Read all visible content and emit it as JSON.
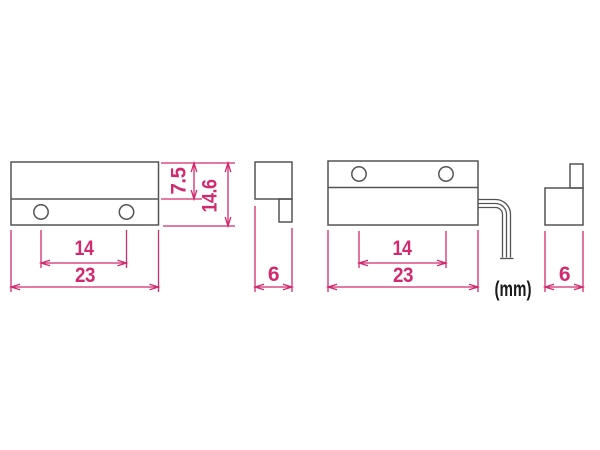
{
  "diagram": {
    "name": "magnetic-contact-switch-dimension-drawing",
    "units_label": "(mm)",
    "colors": {
      "outline": "#545454",
      "dimension": "#d22a6e",
      "units_text": "#1a1a1a",
      "background": "#ffffff"
    },
    "magnet_front": {
      "hole_spacing_mm": "14",
      "width_mm": "23",
      "body_height_mm": "7.5",
      "total_height_mm": "14.6"
    },
    "magnet_side": {
      "depth_mm": "6"
    },
    "switch_front": {
      "hole_spacing_mm": "14",
      "width_mm": "23"
    },
    "switch_side": {
      "depth_mm": "6"
    }
  }
}
